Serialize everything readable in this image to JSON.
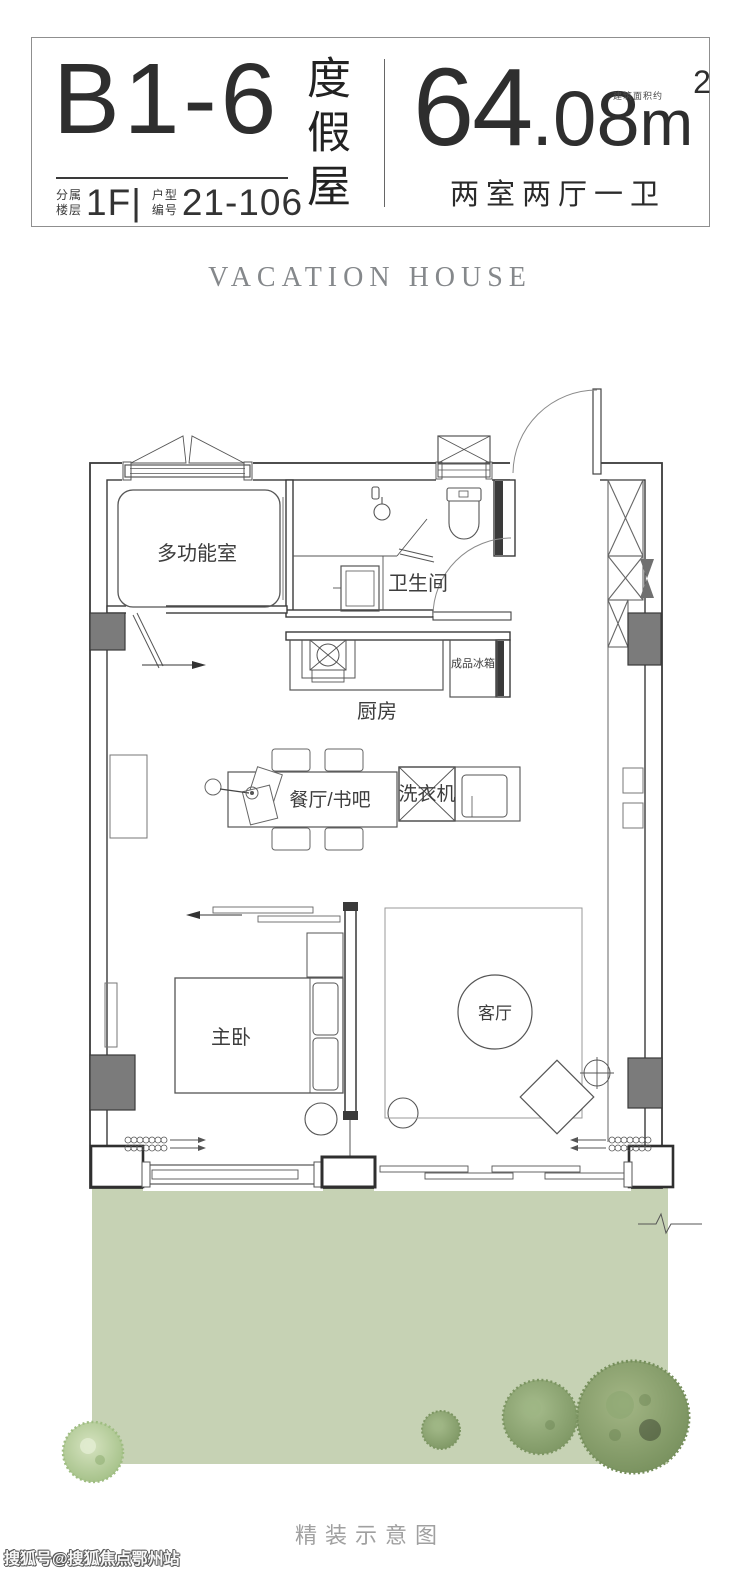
{
  "header": {
    "unit_code": "B1-6",
    "unit_title": "度假屋",
    "floor_label_line1": "分属",
    "floor_label_line2": "楼层",
    "floor_value": "1F|",
    "number_label_line1": "户型",
    "number_label_line2": "编号",
    "number_value": "21-106",
    "area_int": "64",
    "area_dec": ".08",
    "area_unit": "m",
    "area_sup": "2",
    "area_note": "建筑面积约",
    "layout_text": "两室两厅一卫"
  },
  "subtitle": "VACATION HOUSE",
  "floorplan": {
    "rooms": {
      "multi_function": "多功能室",
      "bathroom": "卫生间",
      "kitchen": "厨房",
      "fridge": "成品冰箱",
      "dining": "餐厅/书吧",
      "washer": "洗衣机",
      "master_bedroom": "主卧",
      "living": "客厅"
    }
  },
  "caption": "精装示意图",
  "watermark": "搜狐号@搜狐焦点鄂州站",
  "colors": {
    "lawn": "#c6d2b4",
    "tree_dark": "#7c9562",
    "tree_light": "#b7cf9e",
    "wall": "#3a3a3a",
    "line": "#555555",
    "column_fill": "#7b7b7b"
  }
}
